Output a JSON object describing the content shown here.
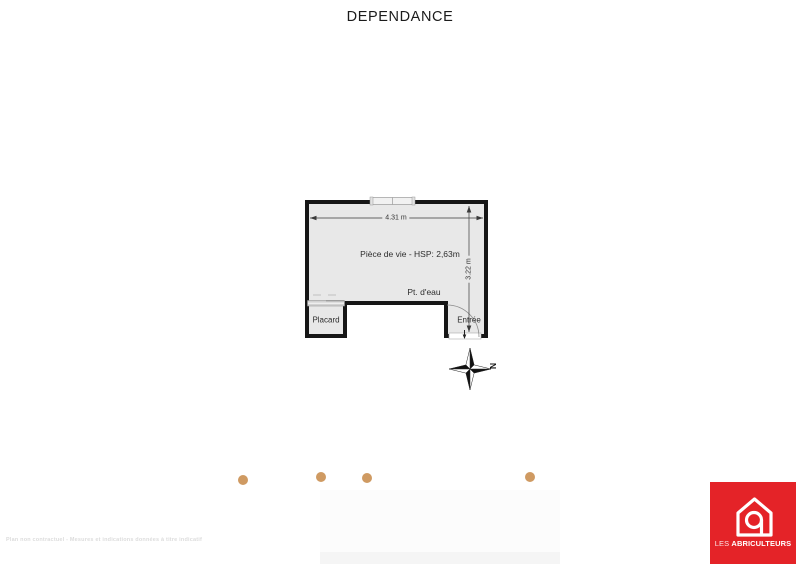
{
  "title": "DEPENDANCE",
  "plan": {
    "room_label": "Pièce de vie  - HSP: 2,63m",
    "water_point_label": "Pt. d'eau",
    "closet_label": "Placard",
    "entrance_label": "Entrée",
    "width_dimension": "4.31 m",
    "height_dimension": "3.22 m",
    "compass_north_label": "N",
    "colors": {
      "floor_fill": "#e8e8e8",
      "wall": "#161616",
      "dimension_line": "#3a3a3a"
    }
  },
  "decorations": {
    "dot_color": "#cf9a62"
  },
  "footer": {
    "disclaimer": "Plan non contractuel - Mesures et indications données à titre indicatif"
  },
  "logo": {
    "brand_prefix": "LES",
    "brand_name": "ABRICULTEURS",
    "background_color": "#e42328"
  }
}
